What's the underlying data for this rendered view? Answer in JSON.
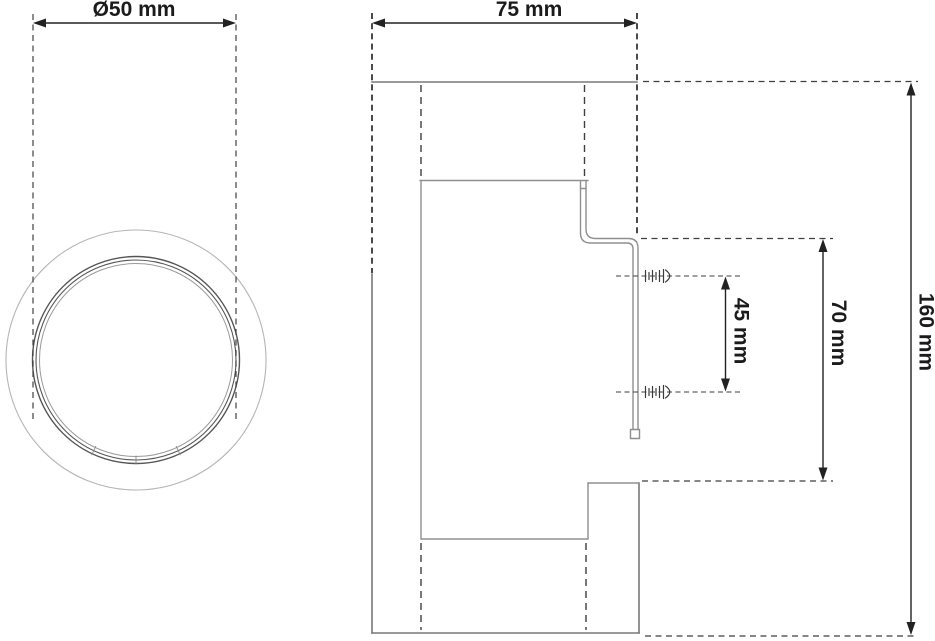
{
  "drawing": {
    "type": "technical-dimension-drawing",
    "views": {
      "front": {
        "description": "front view of round tube with outer rim"
      },
      "side": {
        "description": "side profile with wall bracket and two mounting screws"
      }
    }
  },
  "dimensions": [
    {
      "name": "diameter",
      "label": "Ø50 mm",
      "value": 50,
      "unit": "mm",
      "orientation": "horizontal",
      "view": "front"
    },
    {
      "name": "depth",
      "label": "75 mm",
      "value": 75,
      "unit": "mm",
      "orientation": "horizontal",
      "view": "side"
    },
    {
      "name": "screw-spacing",
      "label": "45 mm",
      "value": 45,
      "unit": "mm",
      "orientation": "vertical",
      "view": "side"
    },
    {
      "name": "bracket-height",
      "label": "70 mm",
      "value": 70,
      "unit": "mm",
      "orientation": "vertical",
      "view": "side"
    },
    {
      "name": "overall-height",
      "label": "160 mm",
      "value": 160,
      "unit": "mm",
      "orientation": "vertical",
      "view": "side"
    }
  ],
  "colors": {
    "background": "#ffffff",
    "dimension_line": "#222222",
    "dimension_text": "#1b1b1b",
    "body_line": "#787878",
    "inner_body_line": "#8f8f8f",
    "hidden_line": "#3f3f3f",
    "light_line": "#b5b5b5"
  }
}
